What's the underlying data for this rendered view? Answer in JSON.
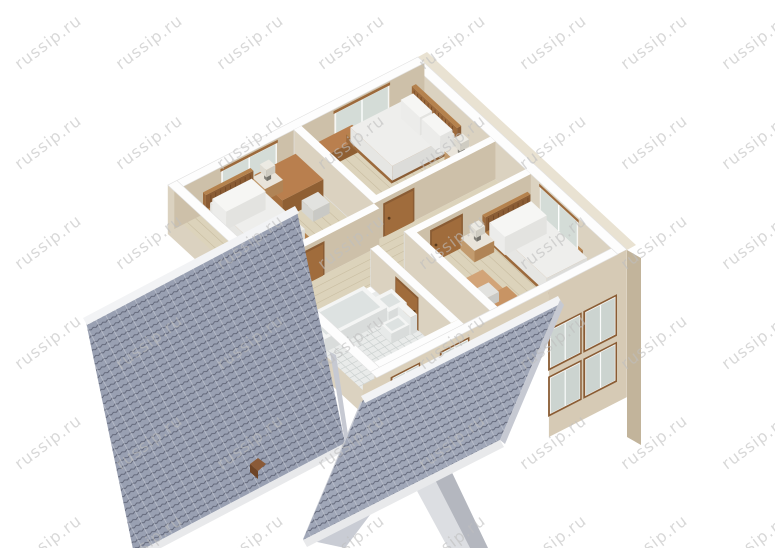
{
  "watermark": {
    "text": "russip.ru",
    "color": "#bfbfbf",
    "opacity": 0.6
  },
  "palette": {
    "background": "#ffffff",
    "wall_top": "#fdfdfd",
    "wall_top_edge": "#e2e2e2",
    "wall_face_light": "#dbd2c0",
    "wall_face_dark": "#cdc0a9",
    "wall_exterior_left": "#cdbfa8",
    "wall_exterior_bottom": "#dbd2c0",
    "facade_tall": "#d6cab5",
    "facade_short": "#dacfba",
    "facade_return": "#c2b49b",
    "facade_sliver": "#e9e2d2",
    "floor_wood": "#dcd3bb",
    "floor_plank_line": "#b7a989",
    "floor_tile": "#e9ebea",
    "tile_line": "#c8cecd",
    "roof_base": "#99a0b2",
    "roof_base_front": "#a0a7b8",
    "roof_row_line": "#5d6274",
    "roof_seam": "#c6cad4",
    "roof_ridge": "#f2f3f5",
    "roof_fascia": "#e8e9eb",
    "roof_barge": "#c6c9d2",
    "gable": "#c9ccd4",
    "porch_light": "#dcdee2",
    "porch_dark": "#b4b7bf",
    "wood_dark": "#8a5c34",
    "wood_mid": "#9c6a3c",
    "wood_light": "#b5824d",
    "door_panel": "#a06c3c",
    "door_frame": "#8a5c34",
    "glass": "#d4dcd7",
    "window_frame": "#f6f6f3",
    "mattress_top": "#eeeeec",
    "mattress_x": "#dcdcd9",
    "mattress_y": "#e6e6e3",
    "pillow": "#f6f6f4",
    "fixture_white": "#f4f5f4",
    "fixture_side": "#d9dcdb",
    "fixture_side2": "#e7eae9",
    "fixture_inner": "#dde2e1",
    "rug_salmon": "#dba884",
    "rug_tan": "#d2a478",
    "desk_top": "#b97f4e",
    "desk_x": "#8f5f33",
    "desk_y": "#a56f3e",
    "chair": "#e2e2df",
    "chair_x": "#c9c9c5",
    "chair_y": "#d6d6d2",
    "lamp_shade": "#eceae3",
    "lamp_stem": "#8f8d86"
  }
}
